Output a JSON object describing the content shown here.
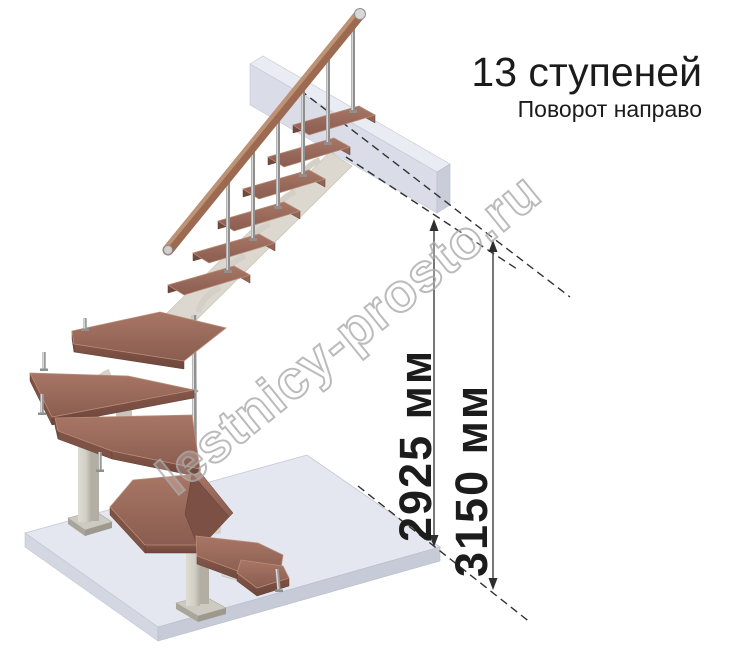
{
  "annotations": {
    "title": "13 ступеней",
    "subtitle": "Поворот направо"
  },
  "dimensions": [
    {
      "label": "2925 мм"
    },
    {
      "label": "3150 мм"
    }
  ],
  "watermark": {
    "text": "lestnicy-prosto.ru"
  },
  "stair": {
    "steps_total": "13",
    "turn": "направо"
  },
  "colors": {
    "tread_wood": "#9a6a5c",
    "tread_side": "#7e5245",
    "handrail_wood": "#9c6a50",
    "steel_support": "#d6d3cb",
    "chrome_baluster": "#8f8f8f",
    "floor_slab": "#e4e7f0",
    "upper_slab": "#d7dae6",
    "dimension_line": "#3d3d3d",
    "text": "#1b1b1b",
    "watermark_gray": "#ababab"
  }
}
